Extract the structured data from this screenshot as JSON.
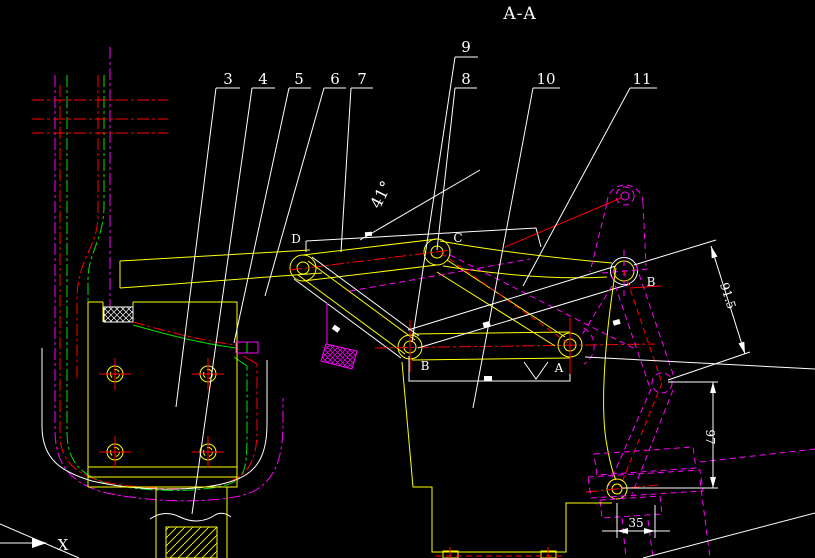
{
  "section_title": "A-A",
  "callouts": [
    {
      "label": "3"
    },
    {
      "label": "4"
    },
    {
      "label": "5"
    },
    {
      "label": "6"
    },
    {
      "label": "7"
    },
    {
      "label": "8"
    },
    {
      "label": "9"
    },
    {
      "label": "10"
    },
    {
      "label": "11"
    }
  ],
  "joint_labels": {
    "d": "D",
    "c": "C",
    "b_left": "B",
    "a": "A",
    "b_right": "B"
  },
  "dimensions": {
    "angle": "41°",
    "vertical": "97",
    "horizontal": "35",
    "link_length": "91.5"
  },
  "axis_indicator": {
    "x_label": "X"
  },
  "colors": {
    "background": "#000000",
    "outline_white": "#ffffff",
    "part_yellow": "#ffff00",
    "centerline_red": "#ff0000",
    "hidden_magenta": "#ff00ff",
    "aux_green": "#00e000"
  }
}
